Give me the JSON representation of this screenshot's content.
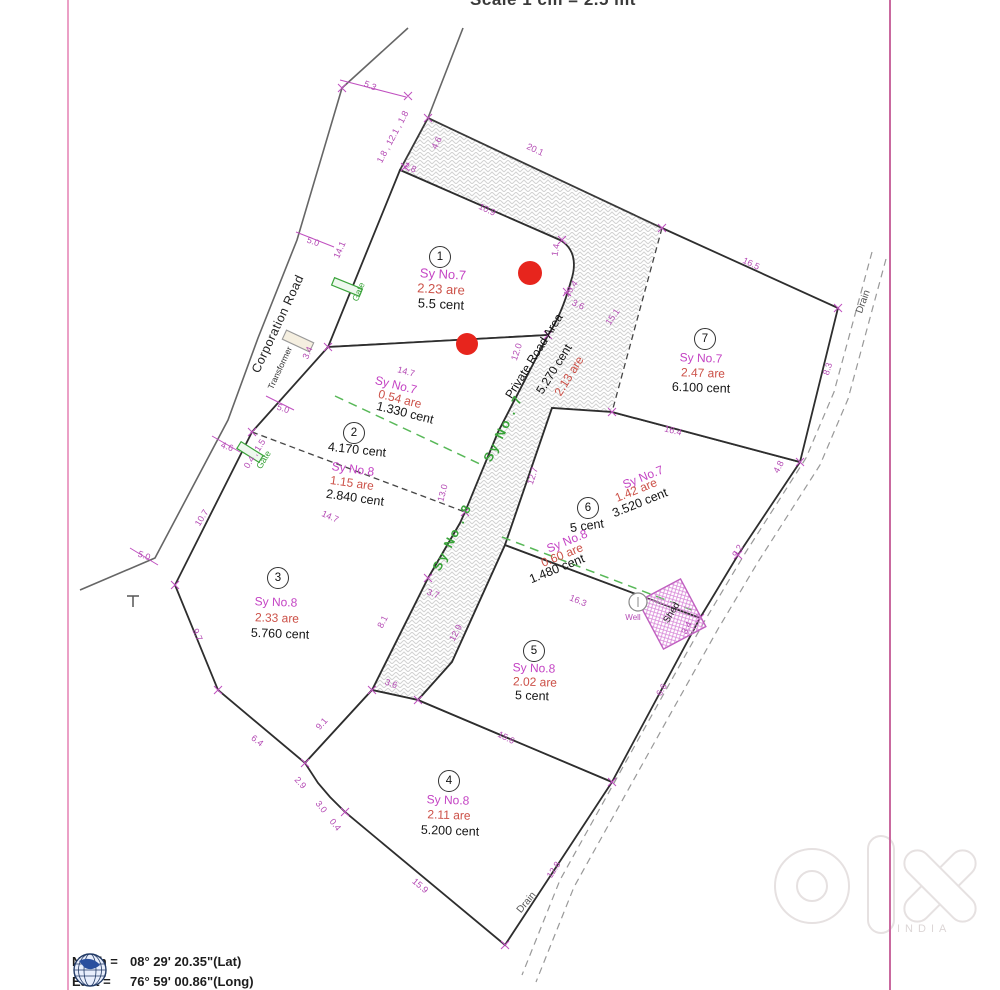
{
  "scale_note": "Scale 1 cm = 2.5 mt",
  "road": {
    "name": "Private Road Area",
    "cent": "5.270 cent",
    "are": "2.13 are",
    "sy_no_8": "Sy No . 8",
    "sy_no_7": "Sy No . 7"
  },
  "streets": {
    "corporation_road": "Corporation Road"
  },
  "markers": {
    "drain": "Drain",
    "gate": "Gate",
    "transformer": "Transformer",
    "shed": "Shed",
    "well": "Well"
  },
  "plots": [
    {
      "number": "1",
      "sy_no": "Sy No.7",
      "are": "2.23 are",
      "cent": "5.5 cent"
    },
    {
      "number": "2",
      "cent_main": "4.170 cent",
      "sy_no": "Sy No.8",
      "are": "1.15 are",
      "cent": "2.840 cent",
      "strip_sy_no": "Sy No.7",
      "strip_are": "0.54 are",
      "strip_cent": "1.330 cent"
    },
    {
      "number": "3",
      "sy_no": "Sy No.8",
      "are": "2.33 are",
      "cent": "5.760 cent"
    },
    {
      "number": "4",
      "sy_no": "Sy No.8",
      "are": "2.11 are",
      "cent": "5.200 cent"
    },
    {
      "number": "5",
      "sy_no": "Sy No.8",
      "are": "2.02 are",
      "cent": "5 cent"
    },
    {
      "number": "6",
      "cent_main": "5 cent",
      "upper_sy_no": "Sy No.7",
      "upper_are": "1.42 are",
      "upper_cent": "3.520 cent",
      "lower_sy_no": "Sy No.8",
      "lower_are": "0.60 are",
      "lower_cent": "1.480 cent"
    },
    {
      "number": "7",
      "sy_no": "Sy No.7",
      "are": "2.47 are",
      "cent": "6.100 cent"
    }
  ],
  "dims": [
    {
      "v": "5.3"
    },
    {
      "v": "1.8 , 12.1 , 1.8"
    },
    {
      "v": "2.8"
    },
    {
      "v": "20.1"
    },
    {
      "v": "4.6"
    },
    {
      "v": "10.9"
    },
    {
      "v": "1.4"
    },
    {
      "v": "10.4"
    },
    {
      "v": "3.6"
    },
    {
      "v": "15.1"
    },
    {
      "v": "12.0"
    },
    {
      "v": "12.7"
    },
    {
      "v": "14.7"
    },
    {
      "v": "13.0"
    },
    {
      "v": "14.7"
    },
    {
      "v": "5.0"
    },
    {
      "v": "14.1"
    },
    {
      "v": "3.4"
    },
    {
      "v": "5.0"
    },
    {
      "v": "4.6"
    },
    {
      "v": "0.4 , 1.5"
    },
    {
      "v": "10.7"
    },
    {
      "v": "5.0"
    },
    {
      "v": "9.7"
    },
    {
      "v": "6.4"
    },
    {
      "v": "2.9"
    },
    {
      "v": "3.0"
    },
    {
      "v": "0.4"
    },
    {
      "v": "9.1"
    },
    {
      "v": "8.1"
    },
    {
      "v": "3.7"
    },
    {
      "v": "12.9"
    },
    {
      "v": "3.6"
    },
    {
      "v": "15.6"
    },
    {
      "v": "15.9"
    },
    {
      "v": "12.8"
    },
    {
      "v": "16.5"
    },
    {
      "v": "8.3"
    },
    {
      "v": "16.4"
    },
    {
      "v": "4.8"
    },
    {
      "v": "9.2"
    },
    {
      "v": "16.3"
    },
    {
      "v": "3.4"
    },
    {
      "v": "6.6"
    }
  ],
  "footer": {
    "north_label": "North =",
    "north_value": "08° 29' 20.35\"(Lat)",
    "east_label": "East =",
    "east_value": "76° 59' 00.86\"(Long)"
  },
  "watermark": {
    "country": "INDIA"
  },
  "colors": {
    "dimension": "#b44ab4",
    "sy_no": "#c444c4",
    "are": "#cc5148",
    "survey_split": "#3aa33a",
    "border": "#d678b0",
    "red_marker": "#e7251d"
  }
}
